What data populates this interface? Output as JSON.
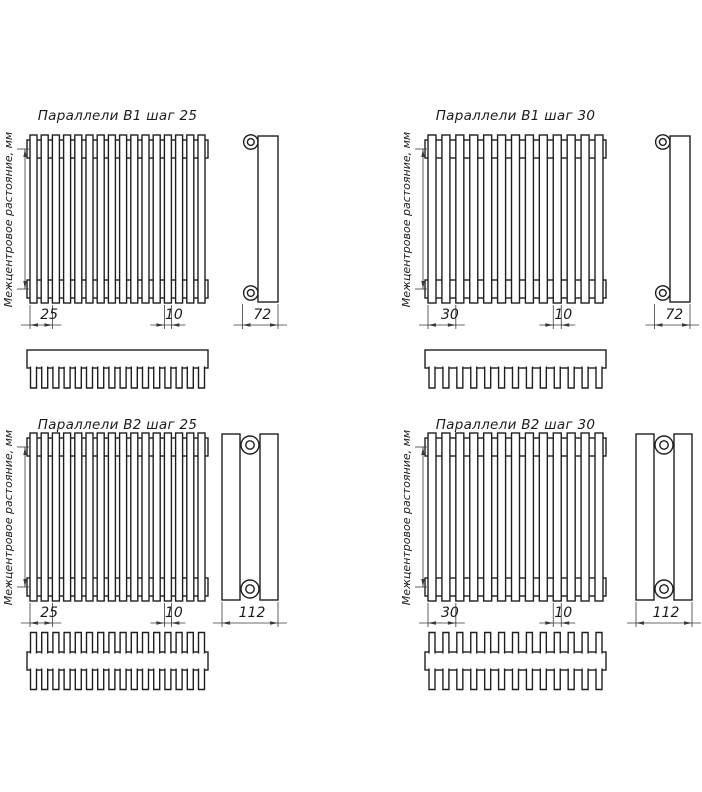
{
  "page": {
    "background": "#ffffff"
  },
  "drawing": {
    "line_color": "#1f1f1f",
    "dim_color": "#3a3a3a",
    "axis_label": "Межцентровое растояние, мм",
    "quadrants": [
      {
        "title": "Параллели В1 шаг 25",
        "model": "В1",
        "step_label": "25",
        "tube_width_label": "10",
        "depth_label": "72",
        "tubes": 16,
        "rows": 1
      },
      {
        "title": "Параллели В1 шаг 30",
        "model": "В1",
        "step_label": "30",
        "tube_width_label": "10",
        "depth_label": "72",
        "tubes": 13,
        "rows": 1
      },
      {
        "title": "Параллели В2 шаг 25",
        "model": "В2",
        "step_label": "25",
        "tube_width_label": "10",
        "depth_label": "112",
        "tubes": 16,
        "rows": 2
      },
      {
        "title": "Параллели В2 шаг 30",
        "model": "В2",
        "step_label": "30",
        "tube_width_label": "10",
        "depth_label": "112",
        "tubes": 13,
        "rows": 2
      }
    ]
  }
}
